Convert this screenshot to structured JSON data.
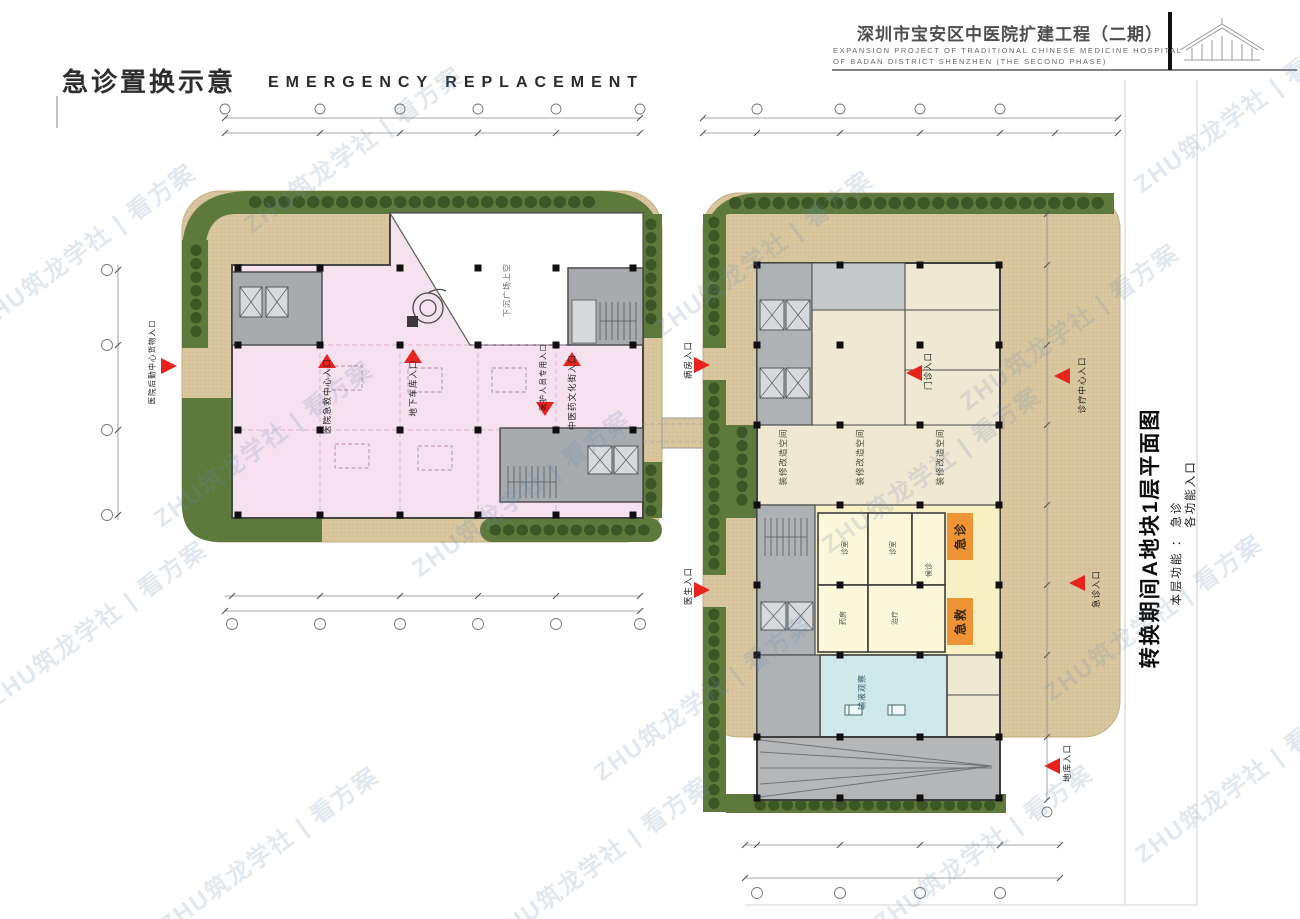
{
  "watermark": {
    "text": "ZHU筑龙学社 | 看方案"
  },
  "header": {
    "sheet_title_cn": "急诊置换示意",
    "sheet_title_en": "EMERGENCY REPLACEMENT",
    "project_title_cn": "深圳市宝安区中医院扩建工程（二期）",
    "project_title_en_line1": "EXPANSION PROJECT OF TRADITIONAL CHINESE MEDICINE HOSPITAL",
    "project_title_en_line2": "OF BADAN DISTRICT SHENZHEN (THE SECOND PHASE)"
  },
  "side_panel": {
    "plan_title": "转换期间A地块1层平面图",
    "floor_function": "本层功能 ： 急诊",
    "entrance_note": "各功能入口"
  },
  "left_plan": {
    "void_label": "下沉广场上空",
    "entrances": {
      "street": "医院后勤中心货物入口",
      "emergency_center": "医院急救中心入口",
      "garage": "地下车库入口",
      "staff": "医护人员专用入口",
      "culture_street": "中医药文化街入口"
    }
  },
  "right_plan": {
    "renovation_space": "装修改造空间",
    "zones": {
      "emergency_outpatient": "急诊",
      "first_aid": "急救"
    },
    "rooms": {
      "consult1": "诊室",
      "consult2": "诊室",
      "pharmacy": "药房",
      "treatment": "治疗",
      "waiting": "候诊",
      "infusion_observation": "输液观察"
    },
    "entrances": {
      "ward": "病房入口",
      "doctor": "医生入口",
      "outpatient": "门诊入口",
      "clinic_center": "诊疗中心入口",
      "emergency": "急诊入口",
      "garage": "地库入口"
    }
  },
  "colors": {
    "plaza_tan": "#d9c7a0",
    "landscape_green": "#5d7a3c",
    "bush_green": "#3c5626",
    "pink_zone": "#f6e2ee",
    "yellow_zone": "#f6f0c4",
    "blue_zone": "#cfe9ea",
    "orange_zone": "#ef9434",
    "entrance_red": "#e8231d",
    "core_gray": "#a7abae"
  }
}
